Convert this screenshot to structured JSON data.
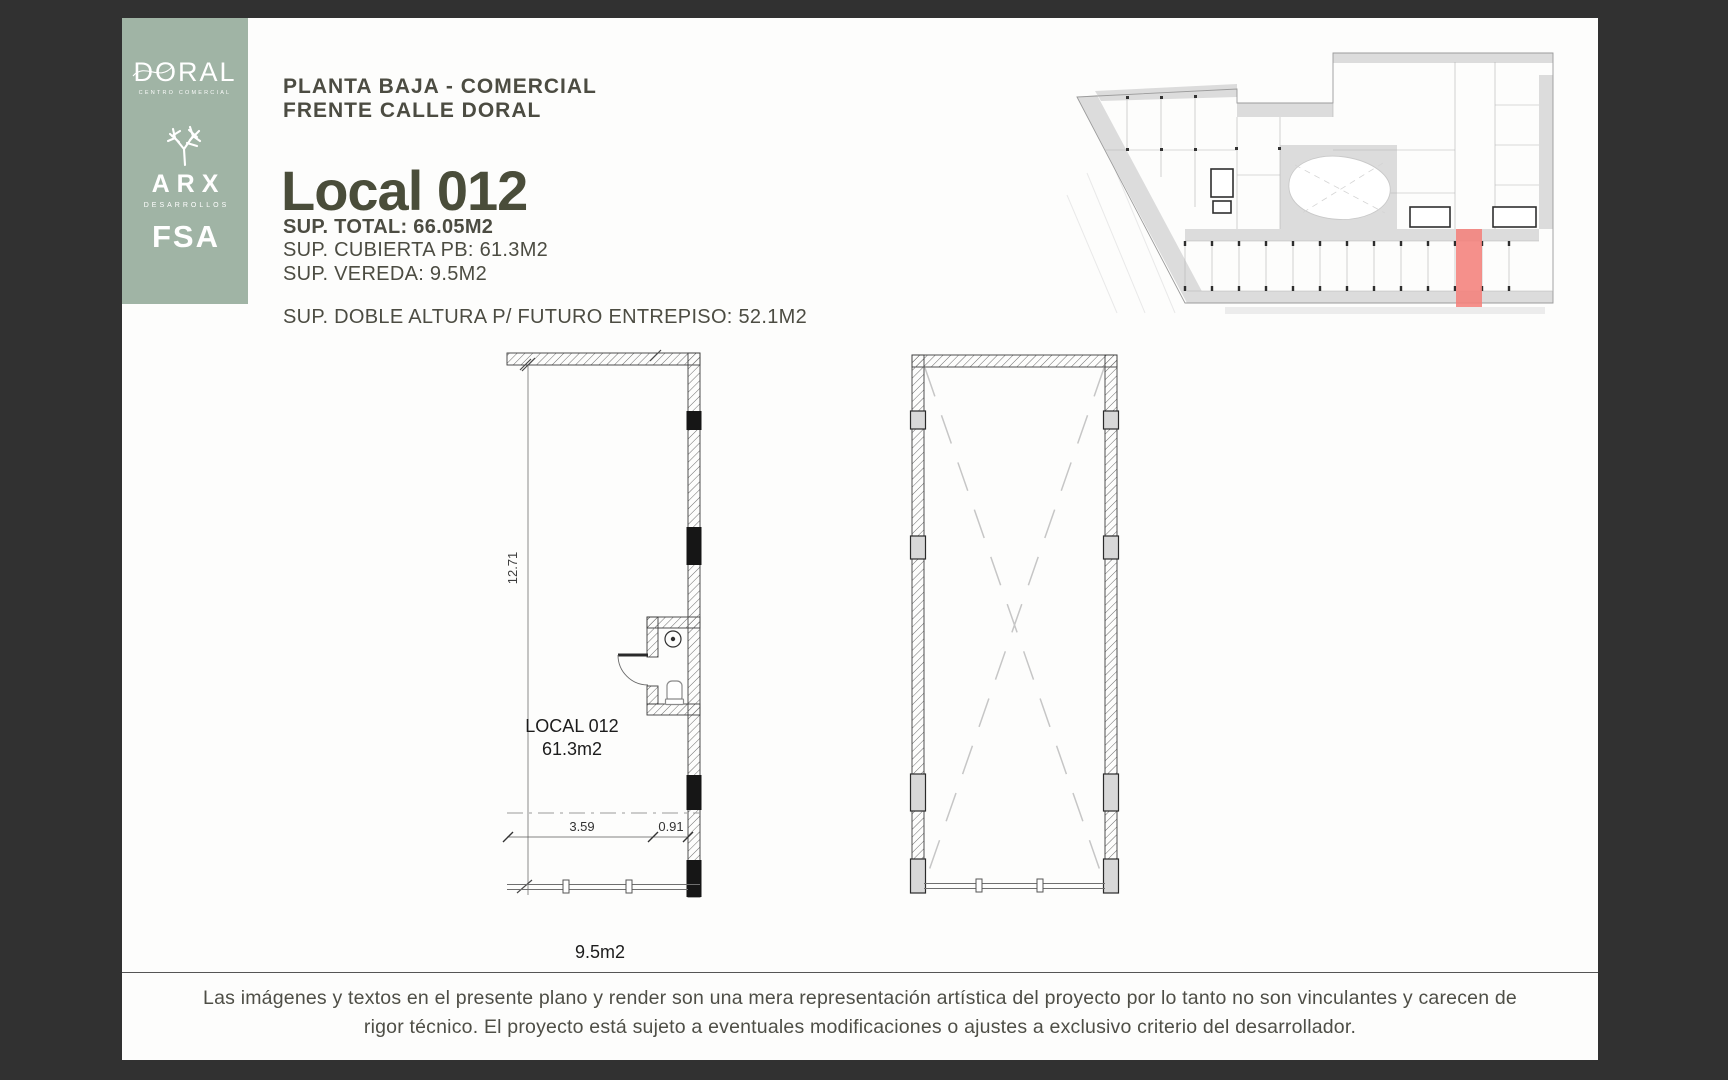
{
  "colors": {
    "background": "#313131",
    "page": "#fdfdfc",
    "sidebar": "#a0b4a5",
    "heading": "#4c4c42",
    "title": "#4a4d3a",
    "highlight": "#f4817b"
  },
  "sidebar": {
    "doral_wordmark": "DORAL",
    "doral_subtitle": "CENTRO COMERCIAL",
    "arx_wordmark": "ARX",
    "arx_subtitle": "DESARROLLOS",
    "fsa_wordmark": "FSA"
  },
  "header": {
    "line1": "PLANTA BAJA - COMERCIAL",
    "line2": "FRENTE CALLE DORAL",
    "title": "Local 012",
    "sup_total": "SUP. TOTAL: 66.05M2",
    "sup_cubierta": "SUP. CUBIERTA PB: 61.3M2",
    "sup_vereda": "SUP. VEREDA: 9.5M2",
    "sup_doble_altura": "SUP. DOBLE ALTURA P/ FUTURO ENTREPISO: 52.1M2"
  },
  "floorplan": {
    "unit_label": "LOCAL 012",
    "unit_area": "61.3m2",
    "depth_dim": "12.71",
    "width_dim": "3.59",
    "entry_dim": "0.91",
    "sidewalk_area": "9.5m2"
  },
  "disclaimer": {
    "text": "Las imágenes y textos en el presente plano y render son una mera representación artística del proyecto por lo tanto no son vinculantes y carecen de rigor técnico. El proyecto está sujeto a eventuales modificaciones o ajustes a exclusivo criterio del desarrollador."
  }
}
